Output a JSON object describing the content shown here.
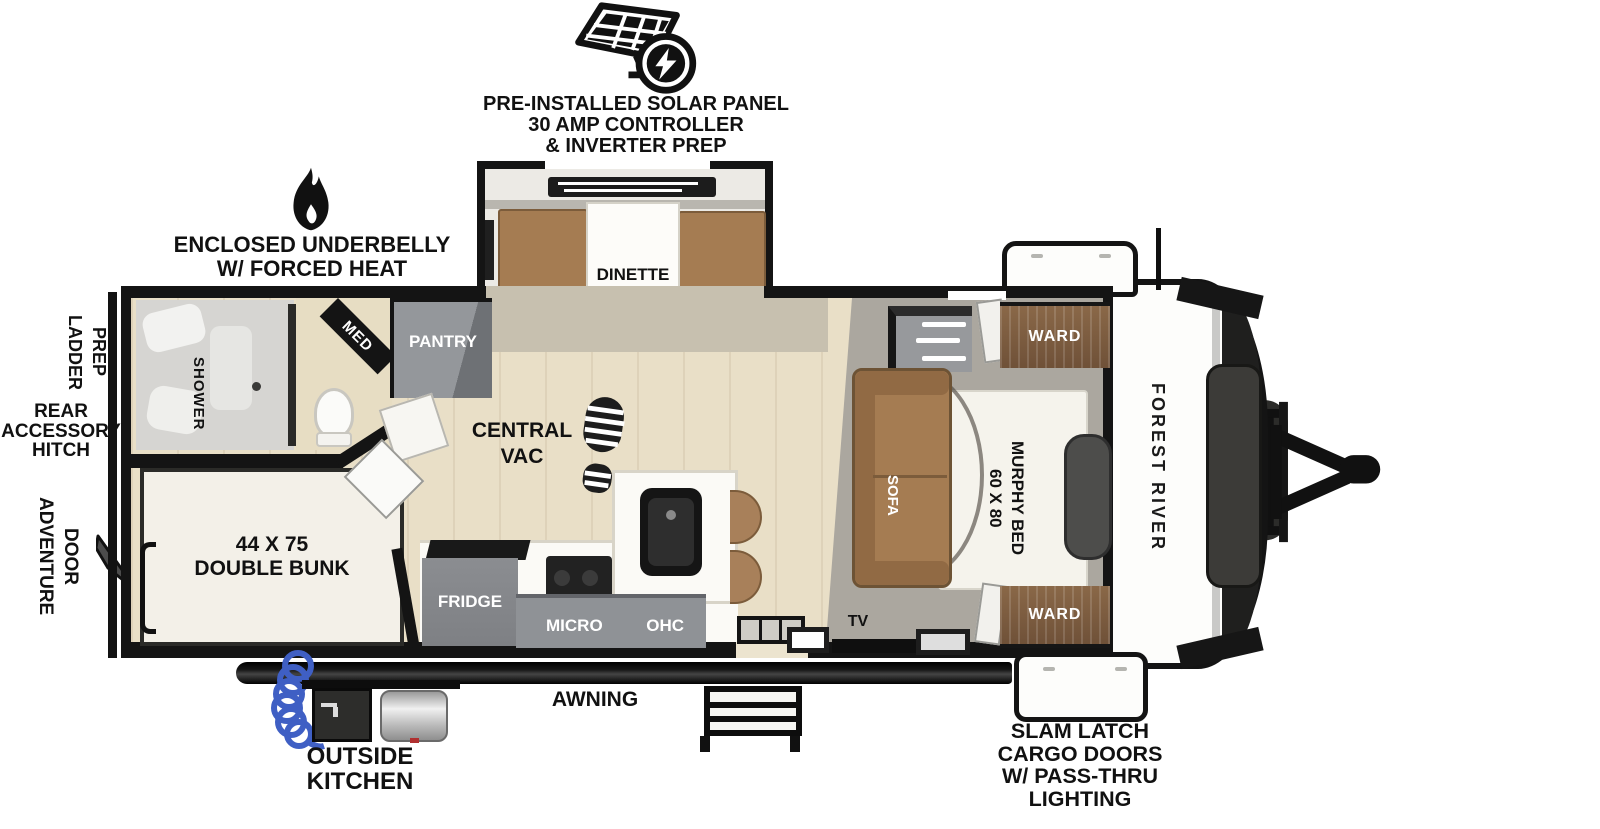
{
  "colors": {
    "wall": "#141414",
    "floor_wood": "#e9dfc7",
    "floor_gray": "#aba79f",
    "furniture_brown": "#a57c52",
    "cabinet_gray": "#8f9296",
    "wood_cabinet": "#7d5c3e",
    "hose_blue": "#3f5fc4"
  },
  "callouts": {
    "solar": {
      "icon": "solar-panel-icon",
      "lines": [
        "PRE-INSTALLED SOLAR PANEL",
        "30 AMP CONTROLLER",
        "& INVERTER PREP"
      ]
    },
    "underbelly": {
      "icon": "flame-icon",
      "lines": [
        "ENCLOSED UNDERBELLY",
        "W/ FORCED HEAT"
      ]
    },
    "ladder_prep": {
      "words": [
        "LADDER",
        "PREP"
      ]
    },
    "rear_hitch": {
      "lines": [
        "REAR",
        "ACCESSORY",
        "HITCH"
      ]
    },
    "adventure_door": {
      "words": [
        "ADVENTURE",
        "DOOR"
      ]
    },
    "outside_kitchen": {
      "lines": [
        "OUTSIDE",
        "KITCHEN"
      ]
    },
    "awning": {
      "label": "AWNING"
    },
    "slam_latch": {
      "lines": [
        "SLAM LATCH",
        "CARGO DOORS",
        "W/ PASS-THRU",
        "LIGHTING"
      ]
    }
  },
  "interior": {
    "dinette": "DINETTE",
    "med": "MED",
    "pantry": "PANTRY",
    "shower": "SHOWER",
    "central_vac": {
      "lines": [
        "CENTRAL",
        "VAC"
      ]
    },
    "sofa": "SOFA",
    "murphy_bed": {
      "words": [
        "60 X 80",
        "MURPHY BED"
      ]
    },
    "ward_top": "WARD",
    "ward_bottom": "WARD",
    "double_bunk": {
      "lines": [
        "44 X 75",
        "DOUBLE BUNK"
      ]
    },
    "fridge": "FRIDGE",
    "micro": "MICRO",
    "ohc": "OHC",
    "tv": "TV"
  },
  "exterior": {
    "brand": "FOREST RIVER"
  }
}
